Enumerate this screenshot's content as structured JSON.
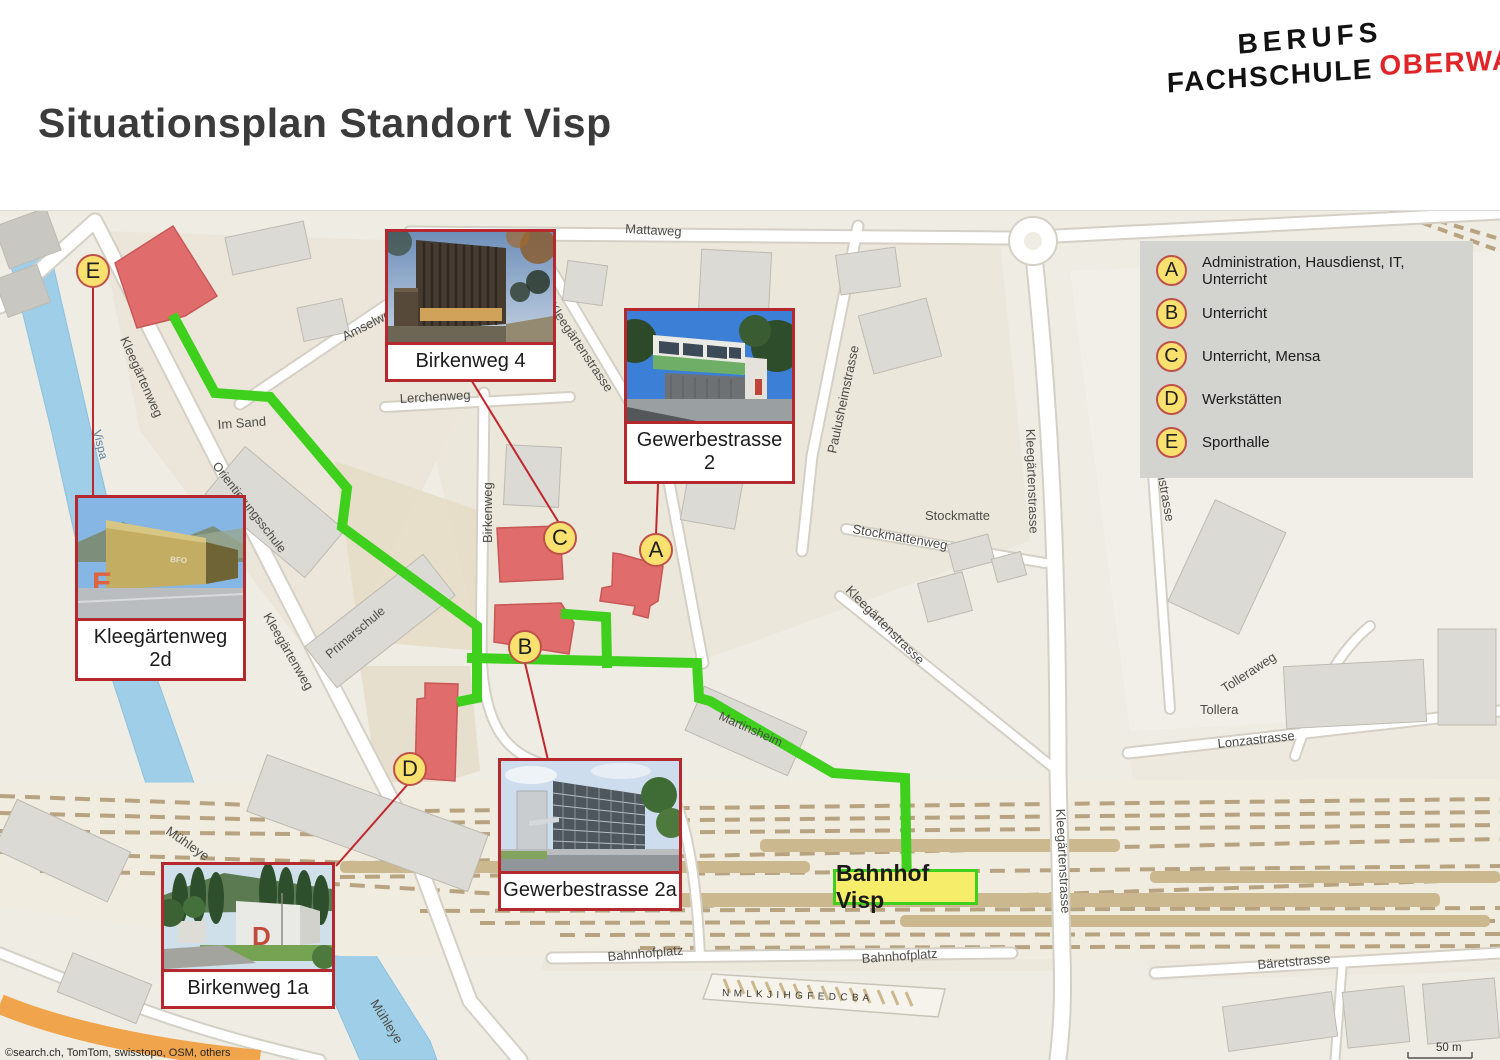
{
  "header": {
    "title": "Situationsplan Standort Visp",
    "logo_line1": "BERUFS",
    "logo_line2_black": "FACHSCHULE",
    "logo_line2_red": "OBERWALLIS"
  },
  "legend": {
    "items": [
      {
        "letter": "A",
        "label": "Administration, Hausdienst, IT, Unterricht"
      },
      {
        "letter": "B",
        "label": "Unterricht"
      },
      {
        "letter": "C",
        "label": "Unterricht, Mensa"
      },
      {
        "letter": "D",
        "label": "Werkstätten"
      },
      {
        "letter": "E",
        "label": "Sporthalle"
      }
    ]
  },
  "markers": [
    {
      "letter": "A"
    },
    {
      "letter": "B"
    },
    {
      "letter": "C"
    },
    {
      "letter": "D"
    },
    {
      "letter": "E"
    }
  ],
  "cards": [
    {
      "label": "Birkenweg 4"
    },
    {
      "label": "Gewerbestrasse 2"
    },
    {
      "label": "Kleegärtenweg 2d"
    },
    {
      "label": "Gewerbestrasse 2a"
    },
    {
      "label": "Birkenweg 1a"
    }
  ],
  "map": {
    "station_label": "Bahnhof Visp",
    "platform_letters": "N M L K J I H G F E D C B A",
    "copyright": "©search.ch, TomTom, swisstopo, OSM, others",
    "scale_label": "50 m",
    "streets": {
      "mattaweg": "Mattaweg",
      "amselweg": "Amselweg",
      "kleegartenstrasse": "Kleegärtenstrasse",
      "paulusheimstrasse": "Paulusheimstrasse",
      "lerchenweg": "Lerchenweg",
      "birkenweg": "Birkenweg",
      "im_sand": "Im Sand",
      "orientierungsschule": "Orientierungsschule",
      "primarschule": "Primarschule",
      "kleegartenweg": "Kleegärtenweg",
      "vispa": "Vispa",
      "stockmatte": "Stockmatte",
      "stockmattenweg": "Stockmattenweg",
      "rottenstrasse": "Rottenstrasse",
      "martinsheim": "Martinsheim",
      "tollera": "Tollera",
      "tolleraweg": "Tolleraweg",
      "lonzastrasse": "Lonzastrasse",
      "bahnhofplatz": "Bahnhofplatz",
      "baretstrasse": "Bäretstrasse",
      "muhleye": "Mühleye"
    }
  },
  "colors": {
    "route_green": "#3ed01c",
    "marker_fill": "#f9e170",
    "marker_border": "#bf5149",
    "building_red": "#e16c6c",
    "logo_red": "#e02528",
    "station_yellow": "#f6ee6a"
  }
}
